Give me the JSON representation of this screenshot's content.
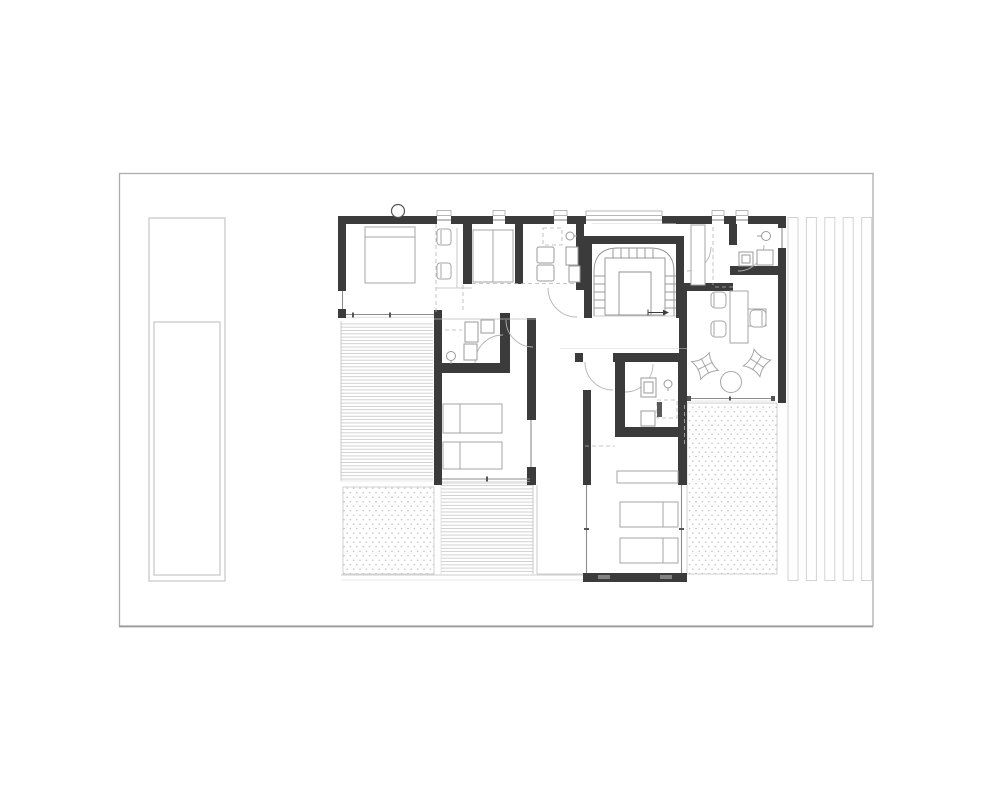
{
  "document": {
    "kind": "architectural-floor-plan",
    "visible_text": "",
    "orientation": "landscape"
  },
  "palette": {
    "paper": "#ffffff",
    "wall_fill": "#3b3b3b",
    "wall_lite": "#818181",
    "furniture_line": "#a6a6a6",
    "fixture_line": "#9a9a9a",
    "door_arc": "#b4b4b4",
    "glass_line": "#8c8c8c",
    "glass_tick": "#555555",
    "stair_line": "#8f8f8f",
    "hatch_line": "#c3c3c3",
    "dot_color": "#c5c5c5",
    "dash_line": "#b5b5b5",
    "thin_line": "#bdbdbd",
    "site_boundary": "#adadad",
    "pool_line": "#c6c6c6",
    "louver_line": "#d3d3d3",
    "frame_line": "#999999"
  },
  "plan": {
    "site_features": [
      "site-boundary",
      "lap-pool",
      "louver-screen",
      "west-deck",
      "south-deck",
      "gravel-court-southwest",
      "east-terrace",
      "covered-walkway"
    ],
    "rooms": [
      "master-bedroom",
      "dressing-area",
      "wardrobe-closet",
      "utility-bathroom",
      "stair-hall",
      "upper-corridor",
      "bathroom-northeast",
      "office-sitting-room",
      "bathroom-center",
      "bedroom-west",
      "bathroom-east",
      "bedroom-south",
      "entry-nook"
    ],
    "furniture": [
      "double-bed",
      "dressing-chairs",
      "built-in-wardrobe",
      "washer-dryer-stack",
      "desk",
      "desk-chairs",
      "lounge-chairs",
      "coffee-table",
      "single-beds",
      "dresser",
      "toilets",
      "sinks",
      "shower"
    ],
    "circulation": [
      "u-shaped-stair",
      "stair-direction-arrow",
      "door-swings"
    ]
  }
}
